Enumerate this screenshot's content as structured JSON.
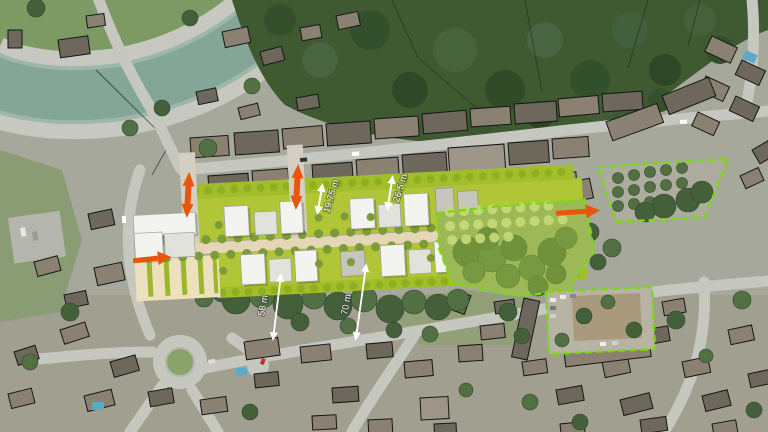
{
  "view": {
    "description": "Aerial photograph with urban design masterplan overlay",
    "width_px": 768,
    "height_px": 432
  },
  "measurements": {
    "north_setback_1": {
      "label": "19.75 m"
    },
    "north_setback_2": {
      "label": "26.5 m"
    },
    "south_distance_1": {
      "label": "58 m"
    },
    "south_distance_2": {
      "label": "70 m"
    }
  },
  "icons": {
    "entry_arrow_west": "orange-arrow-right",
    "link_arrow_north_1": "orange-double-arrow-vertical",
    "link_arrow_north_2": "orange-double-arrow-vertical",
    "exit_arrow_east": "orange-arrow-right",
    "dimension_arrow": "white-double-arrow",
    "site_boundary": "green-dashed-outline"
  },
  "colors": {
    "arrow_accent": "#e8560d",
    "plan_lawn_green": "#b0c636",
    "plan_strip_green": "#a2be2a",
    "park_overlay_green": "#9cc63c",
    "boundary_dash_green": "#7cd80f",
    "spine_road_beige": "#e4d6b6",
    "parking_beige": "#ece0bd",
    "new_building_white": "#f3f3ef",
    "river_teal": "#84a697",
    "measurement_white": "#ffffff"
  }
}
